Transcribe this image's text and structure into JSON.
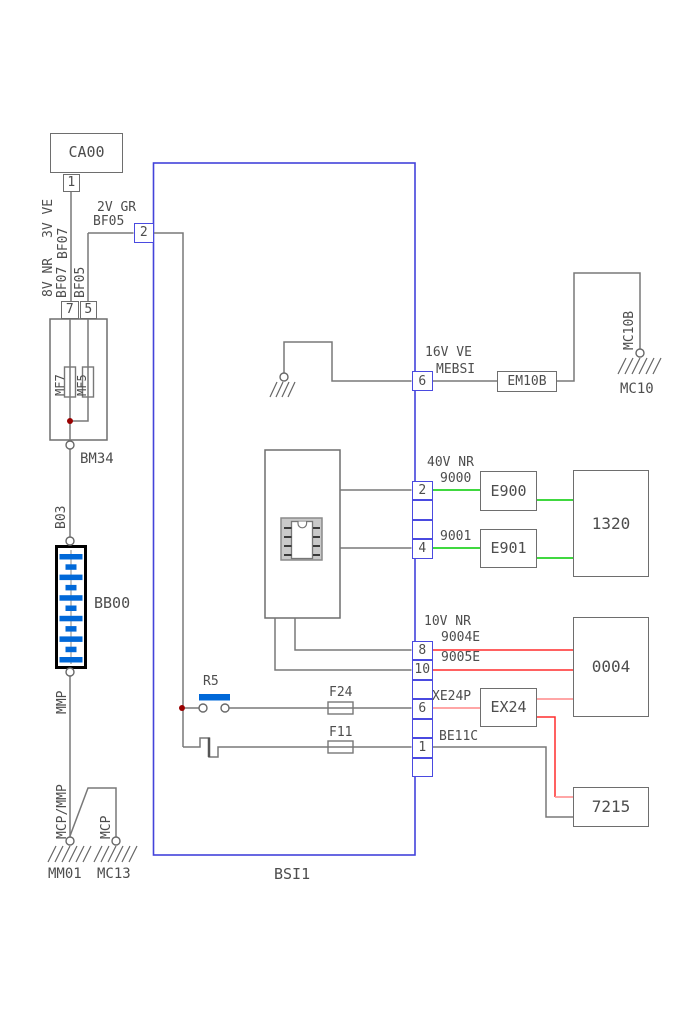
{
  "colors": {
    "ink": "#4d4d4d",
    "wire": "#787878",
    "bsi_border": "#4343da",
    "pin_border": "#4a4ae0",
    "green": "#00cc00",
    "red": "#ff2d2d",
    "salmon": "#ff9a9a",
    "component_blue": "#0068d8",
    "junction_red": "#990000",
    "box_border": "#6e6e6e"
  },
  "diagram": {
    "supply": {
      "source_box": "CA00",
      "source_pin": "1",
      "wire1_gauge": "3V VE",
      "wire1_name": "BF07",
      "wire2_gauge": "2V GR",
      "wire2_name": "BF05",
      "wire3_gauge": "8V NR",
      "wire3_name": "BF07",
      "wire4_name": "BF05"
    },
    "fusebox": {
      "pin_mf7": "7",
      "pin_mf5": "5",
      "fuse_mf7": "MF7",
      "fuse_mf5": "MF5",
      "name": "BM34"
    },
    "battery": {
      "wire_top": "B03",
      "name": "BB00",
      "wire_bottom": "MMP"
    },
    "grounding": {
      "wire_main": "MCP/MMP",
      "wire_branch": "MCP",
      "ground_main": "MM01",
      "ground_branch": "MC13"
    },
    "bsi": {
      "name": "BSI1",
      "pin_supply": "2",
      "relay": "R5",
      "fuse_f24": "F24",
      "fuse_f11": "F11"
    },
    "mebsi": {
      "pin": "6",
      "gauge": "16V VE",
      "wire": "MEBSI",
      "inline_connector": "EM10B",
      "ground_wire": "MC10B",
      "ground": "MC10"
    },
    "circuit_40v": {
      "gauge": "40V NR",
      "pin_a": "2",
      "pin_b": "4",
      "wire_a": "9000",
      "wire_b": "9001",
      "connector_a": "E900",
      "connector_b": "E901",
      "component": "1320"
    },
    "circuit_10v": {
      "gauge": "10V NR",
      "pin_a": "8",
      "pin_b": "10",
      "wire_a": "9004E",
      "wire_b": "9005E",
      "component": "0004"
    },
    "circuit_x": {
      "pin": "6",
      "wire": "XE24P",
      "connector": "EX24",
      "component": "7215"
    },
    "circuit_be": {
      "pin": "1",
      "wire": "BE11C"
    }
  }
}
